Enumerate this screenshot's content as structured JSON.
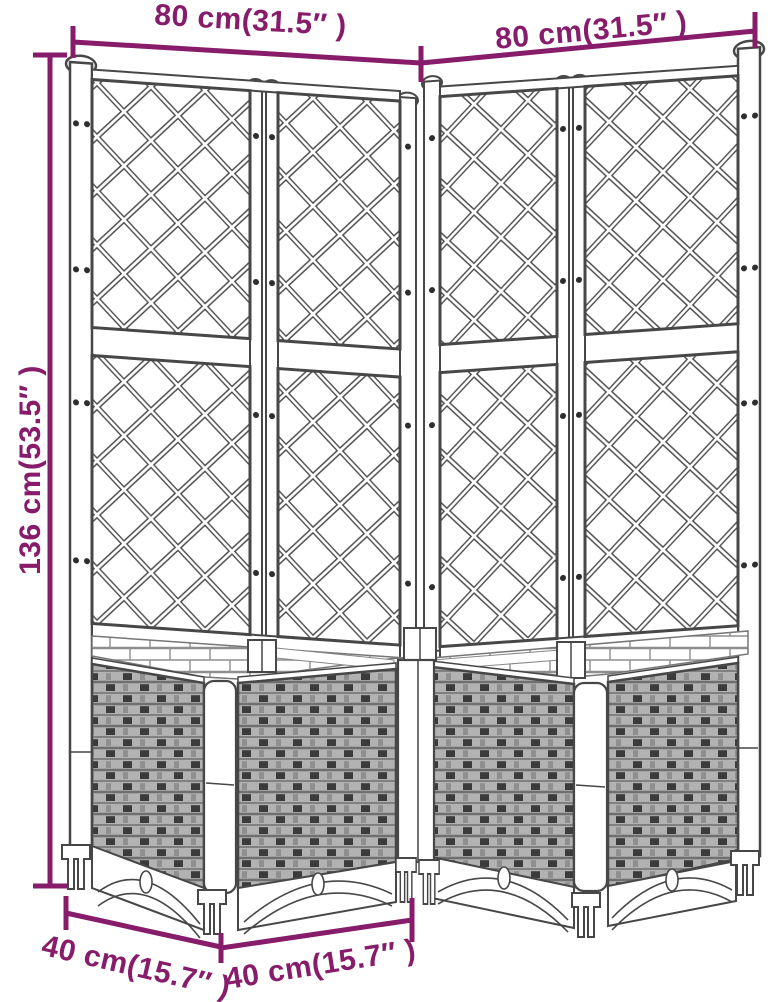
{
  "colors": {
    "accent": "#871c6a",
    "line_art": "#474747"
  },
  "dimension_labels": {
    "top_left": "80 cm(31.5″ )",
    "top_right": "80 cm(31.5″ )",
    "height": "136 cm(53.5″ )",
    "bottom_left": "40 cm(15.7″ )",
    "bottom_right": "40 cm(15.7″ )"
  }
}
